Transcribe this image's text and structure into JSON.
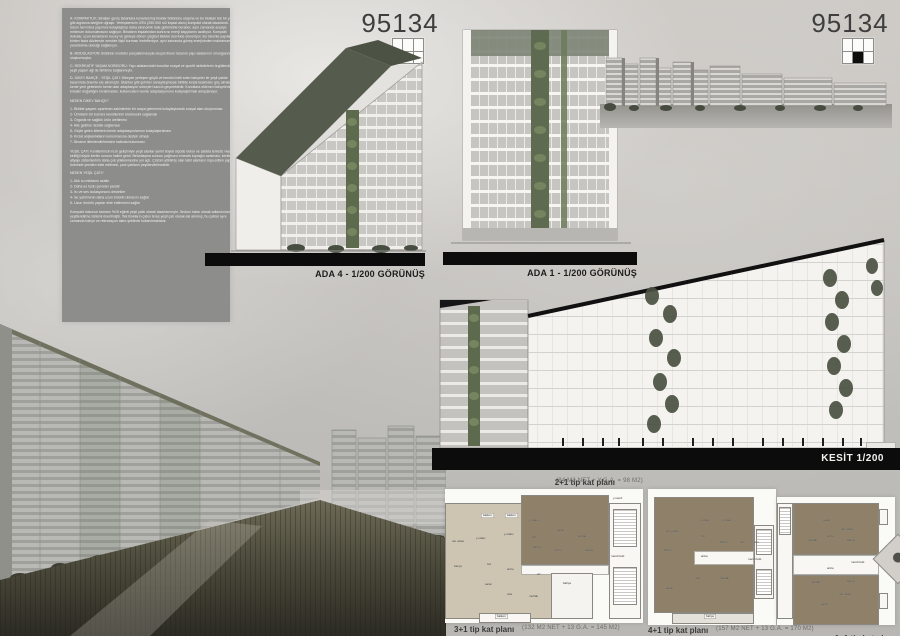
{
  "board": {
    "sheet_number_left": "95134",
    "sheet_number_right": "95134",
    "locator_left_filled": "bottom-left",
    "locator_right_filled": "bottom-center"
  },
  "text_panel": {
    "blocks": [
      "A- KOMPAKTLIK: Binaları geniş tabanlara konarlanmış bloklar bütününe ulaşma ve bu blokları tek bir yapı gibi algılama isteğine uğraşır. Yerleşkemizin 3/5'ü (250.000 m2 inşaat alanı) kompakt olarak tasarlandı. Bu tutum hem bina yapımını kolaylaştırıp daha ekonomik hale getirmekle beraber, aynı zamanda araziye minimum dokunulmasını sağlıyor. Binaların inşaatından sonra ısı enerji kayıplarını azaltıyor. Kompakt dokular, uzun kenarlarını kuzey ve güneye dönen çizgisel bloklar üzerinde deneniyor. Bu tutumla yapıların birden fazla düzlemde zeminle ilişki kurması hedefleniyor, aynı zamanda güneş enerjisinden maksimum yararlanma olanağı sağlanıyor.",
      "B- MODÜLASYON: Bütünün modüler parçalanmasıyla oluşan lineer tasarım yapı adalarının omurgasını oluşturmuştur.",
      "C- REKREATİF YAŞAM KORİDORU: Yapı adalarındaki konutlar sosyal ve sportif aktivitelerin örgütlendiği yeşil yaşam ağı ile birbirine bağlanmıştır.",
      "D- DİKEY BAHÇE - YEŞİL ÇATI: Dikeyde yerleşen güçlü ve kendini belli eden bahçeler ile yeşil çatılar tasarımda önemle ele alınmıştır. İstanbul gibi şehirler sanayileşmeyle birlikte kırsal kesimden göç almakta ve kente yeni gelenlerin kente olan adaptasyon süreçleri sancılı geçmektedir. Konutlara eklenen bahçelerle, kırsalın doğallığını bırakmadan, kullanıcıların kente adaptasyonunu kolaylaştırmak amaçlanıyor.",
      "NEDEN DİKEY BAHÇE?",
      "1- Birlikte yaşam: apartman sakinlerinin bir araya gelmesini kolaylaştırarak sosyal alan oluşturması",
      "2- Ürünlerin bir kısmını kendilerinin üretmesini sağlamak",
      "3- Organik ve sağlıklı ürün üretilmesi",
      "4- Aile gelirine destek sağlaması",
      "5- Göçle gelen kitlelerin kente adaptasyonlarının kolaylaştırılması",
      "6- Kırsal alışkanlıkların korunmasına destek olması",
      "7- Binanın iklimlendirilmesine katkıda bulunması",
      "YEŞİL ÇATI: Kentlerimizin hızlı gelişimiyle yeşil alanlar yerini büyük ölçüde beton ve asfalta terketti. Hava kirliliği büyük kentin sorunu haline geldi. Betonlaşma sonucu yağmuru emecek toprağın azalması, kentlerin altyapı sistemlerinin daha çok yüklenmesine yol açtı. Çözüm yitirilmiş olan tabii alanların inşa edilen yapılar üzerinde yeniden elde edilmesi, yani çatıların yeşillendirilmesidir.",
      "NEDEN YEŞİL ÇATI?",
      "1- Atık su miktarını azaltır",
      "2- Daha az tozlu çevreler yaratır",
      "3- Isı ve ses izolasyonunu destekler",
      "4- Su yalıtımının daha uzun ömürlü olmasını sağlar",
      "5- Uzun ömürlü yapılar elde edilmesini sağlar",
      "Kompakt dokunun tamamı %15 eğimli yeşil çatılı olarak tasarlanmıştır. Sedum halısı olarak adlandırılan yeşillendirme sistemi önerilmiştir. Tek blokların çatısı teras yeşil çatı olarak ele alınmış, bu çatılar aynı zamanda bahçe ve rekreasyon alanı şeklinde kullanılmaktadır."
    ]
  },
  "drawings": {
    "ada4_label": "ADA 4 - 1/200 GÖRÜNÜŞ",
    "ada1_label": "ADA 1 - 1/200 GÖRÜNÜŞ",
    "kesit_label": "KESİT 1/200"
  },
  "plans": {
    "a": {
      "title": "2+1 tip kat planı",
      "title_info": "(84 M2 NET + Y.G.A. = 98 M2)",
      "bottom_label": "3+1 tip kat planı",
      "bottom_info": "(132 M2 NET + 13 G.A. = 145 M2)",
      "rooms": [
        "balkon",
        "balkon",
        "y.odası",
        "otu.odası",
        "y.odası",
        "y.odası",
        "salon",
        "mutfak",
        "hol",
        "banyo",
        "antre",
        "banyo",
        "hol",
        "antre",
        "wc",
        "salon",
        "oda",
        "mutfak",
        "bahçe",
        "merd.holü",
        "asans.",
        "y.merd.",
        "balkon"
      ]
    },
    "b": {
      "label": "4+1 tip kat planı",
      "info": "(157 M2 NET + 13 G.A. = 170 M2)",
      "rooms": [
        "y.odası",
        "y.odası",
        "ebv.odası",
        "hol",
        "banyo",
        "asn.",
        "asn.",
        "banyo",
        "antre",
        "merd.holü",
        "oda",
        "mutfak",
        "salon",
        "bahçe"
      ]
    },
    "c": {
      "label": "1+1 tip kat planı",
      "info": "(44 M2 NET + 8 G.A. = 52 M2)",
      "rooms": [
        "salon",
        "antre",
        "otu.odası",
        "mutfak",
        "banyo",
        "merd.holü",
        "mutfak",
        "banyo",
        "otu.odası",
        "salon",
        "antre"
      ]
    }
  },
  "colors": {
    "panel_gray": "#8d8d8b",
    "bar_black": "#0c0c0c",
    "roof_green": "#565c4d",
    "plant_green": "#5d6a4e",
    "plan_brown": "#8e8069",
    "plan_beige": "#cdc5b2"
  }
}
